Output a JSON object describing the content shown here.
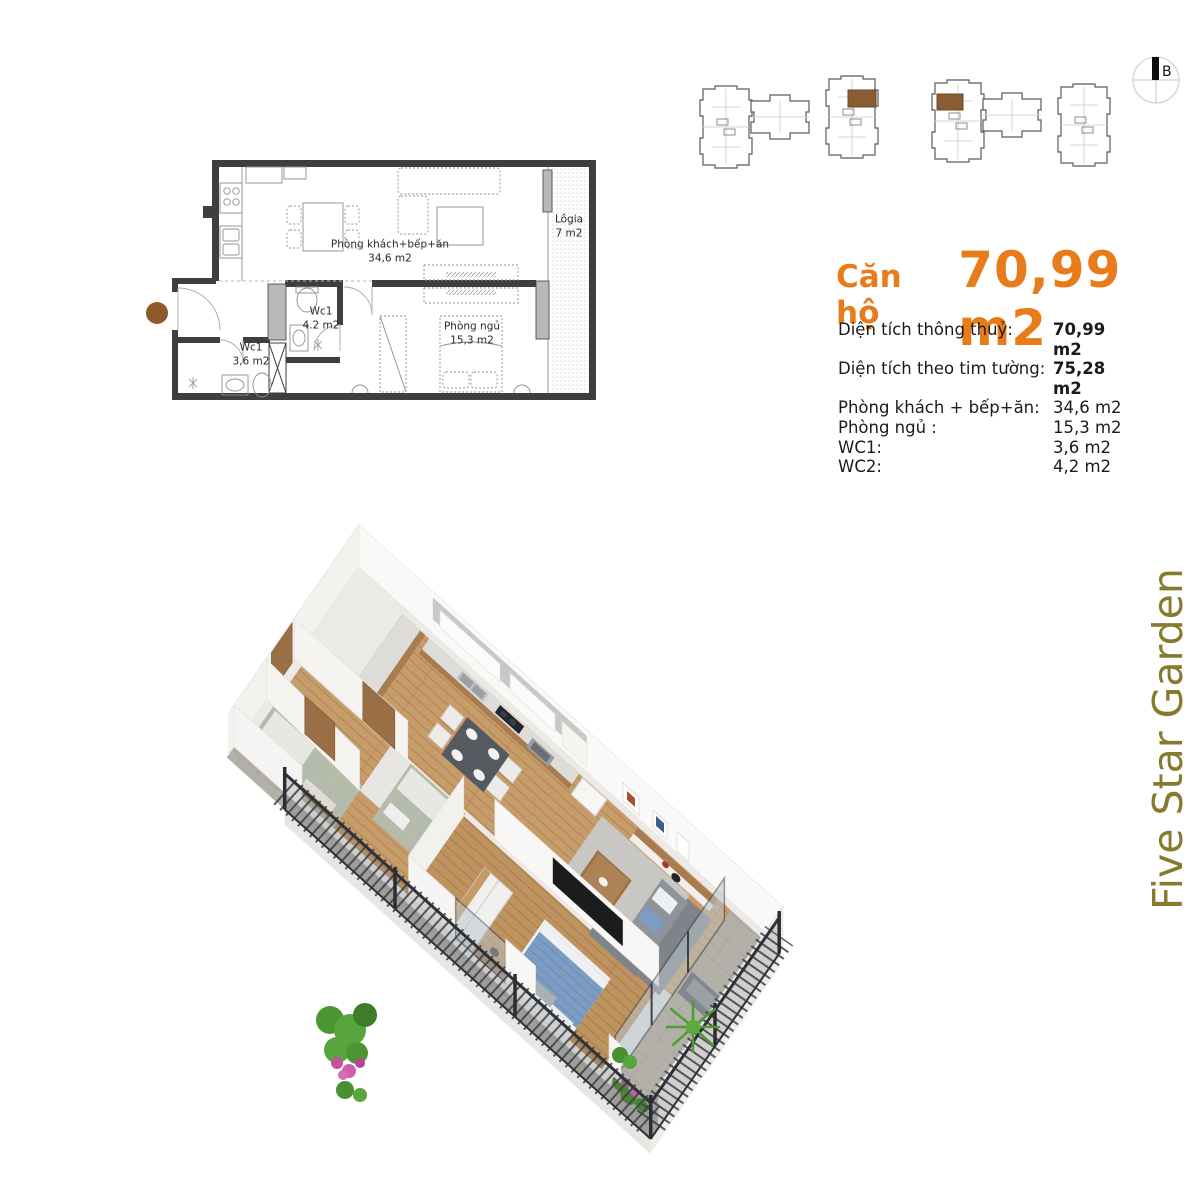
{
  "title": {
    "prefix": "Căn hộ",
    "area": "70,99 m2"
  },
  "specs": {
    "rows": [
      {
        "label": "Diện tích thông thuỷ:",
        "value": "70,99 m2"
      },
      {
        "label": "Diện tích theo tim tường:",
        "value": "75,28 m2"
      },
      {
        "label": "Phòng khách + bếp+ăn:",
        "value": "34,6 m2"
      },
      {
        "label": "Phòng ngủ :",
        "value": "15,3 m2"
      },
      {
        "label": "WC1:",
        "value": "3,6 m2"
      },
      {
        "label": "WC2:",
        "value": "4,2 m2"
      }
    ]
  },
  "floorplan": {
    "rooms": [
      {
        "name": "Phòng khách+bếp+ăn",
        "area": "34,6 m2"
      },
      {
        "name": "Phòng ngủ",
        "area": "15,3 m2"
      },
      {
        "name": "Wc1",
        "area": "4.2 m2"
      },
      {
        "name": "Wc1",
        "area": "3,6 m2"
      },
      {
        "name": "Lôgia",
        "area": "7 m2"
      }
    ],
    "entrance_marker": "brown-dot"
  },
  "site_plan": {
    "buildings": 2,
    "highlighted_unit_color": "#8a5c33"
  },
  "compass": {
    "label": "B"
  },
  "watermark": {
    "text": "Five Star Garden"
  },
  "colors": {
    "accent_orange": "#E87C1B",
    "watermark_olive": "#867B2D",
    "highlight_brown": "#8a5c33",
    "wall_dark": "#3e3e3e"
  }
}
